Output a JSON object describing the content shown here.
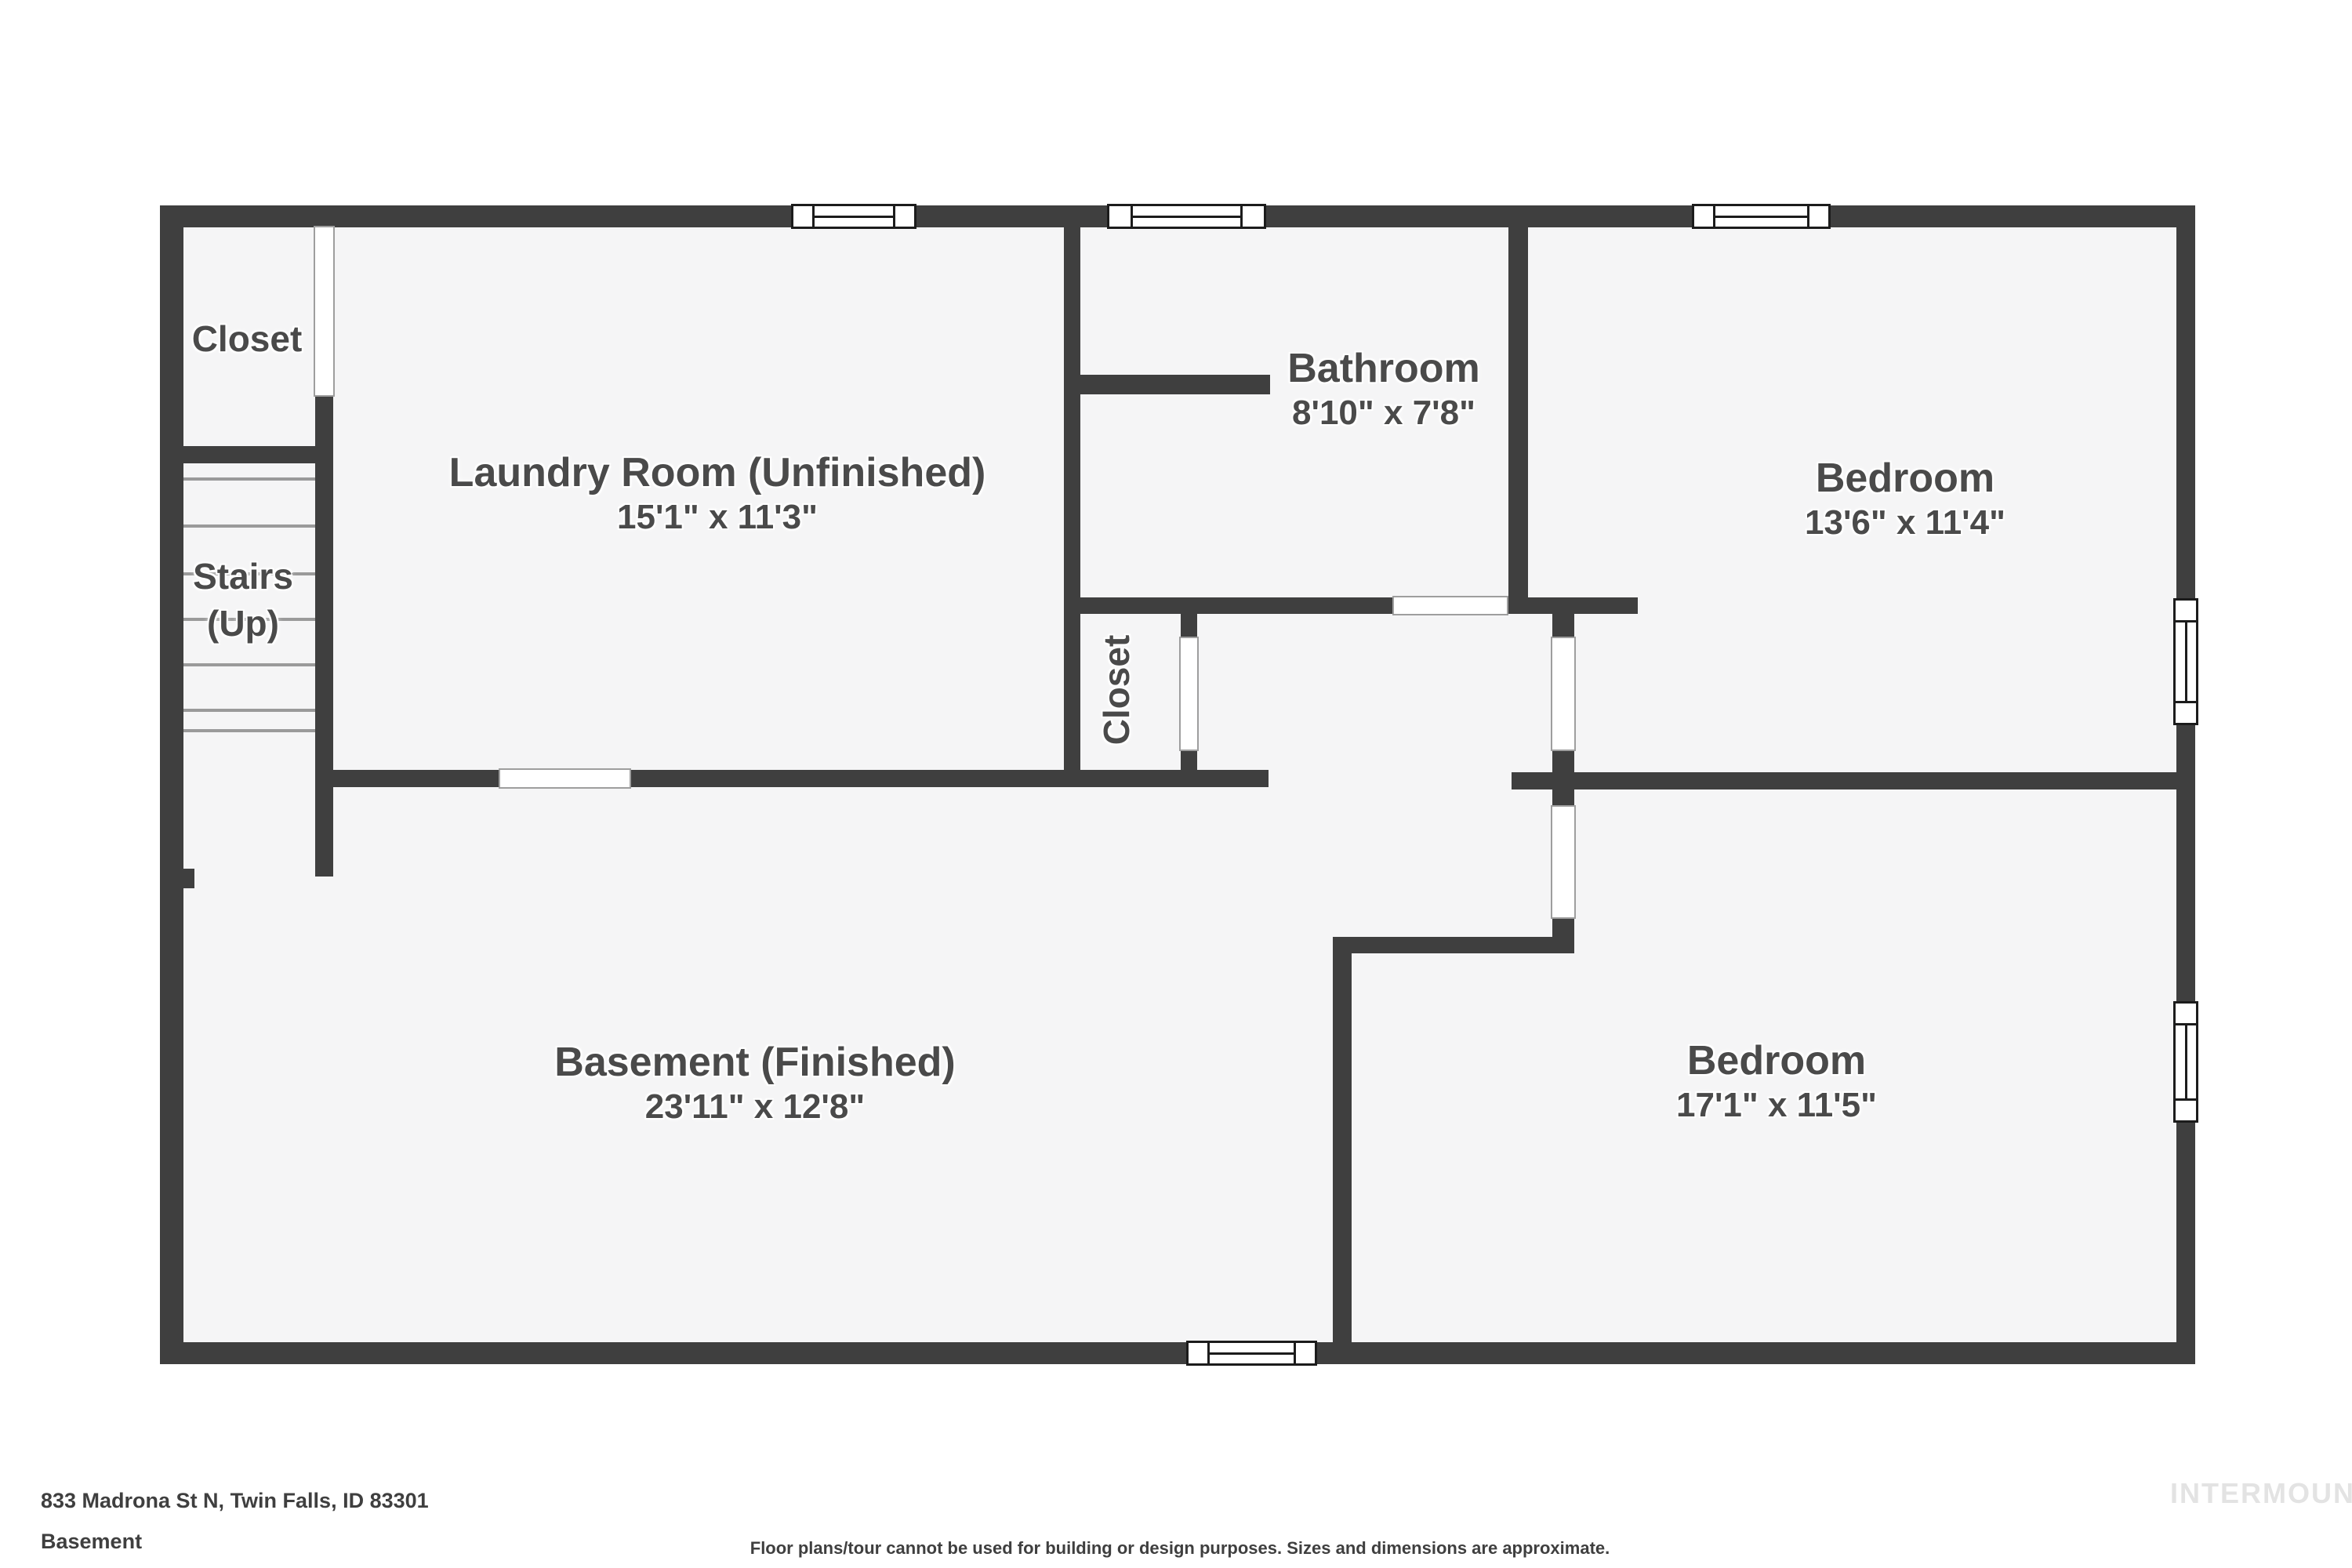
{
  "rooms": {
    "closet_top_left": {
      "name": "Closet"
    },
    "stairs": {
      "name": "Stairs",
      "sub": "(Up)"
    },
    "laundry": {
      "name": "Laundry Room (Unfinished)",
      "dims": "15'1\" x 11'3\""
    },
    "bathroom": {
      "name": "Bathroom",
      "dims": "8'10\" x 7'8\""
    },
    "bedroom_top_right": {
      "name": "Bedroom",
      "dims": "13'6\" x 11'4\""
    },
    "closet_hall": {
      "name": "Closet"
    },
    "basement": {
      "name": "Basement (Finished)",
      "dims": "23'11\" x 12'8\""
    },
    "bedroom_bottom_right": {
      "name": "Bedroom",
      "dims": "17'1\" x 11'5\""
    }
  },
  "footer": {
    "address": "833 Madrona St N, Twin Falls, ID 83301",
    "floor_label": "Basement",
    "disclaimer": "Floor plans/tour cannot be used for building or design purposes. Sizes and dimensions are approximate.",
    "watermark": "INTERMOUNTAIN"
  },
  "colors": {
    "wall": "#3f3f3f",
    "floor": "#f5f5f6",
    "background": "#ffffff",
    "label": "#4a4a4a",
    "door": "#ffffff",
    "door_border": "#9e9e9e",
    "window_border": "#1c1c1c",
    "footer_text": "#3f3f3f",
    "watermark": "#e3e3e3",
    "tread": "#9a9a9a"
  }
}
